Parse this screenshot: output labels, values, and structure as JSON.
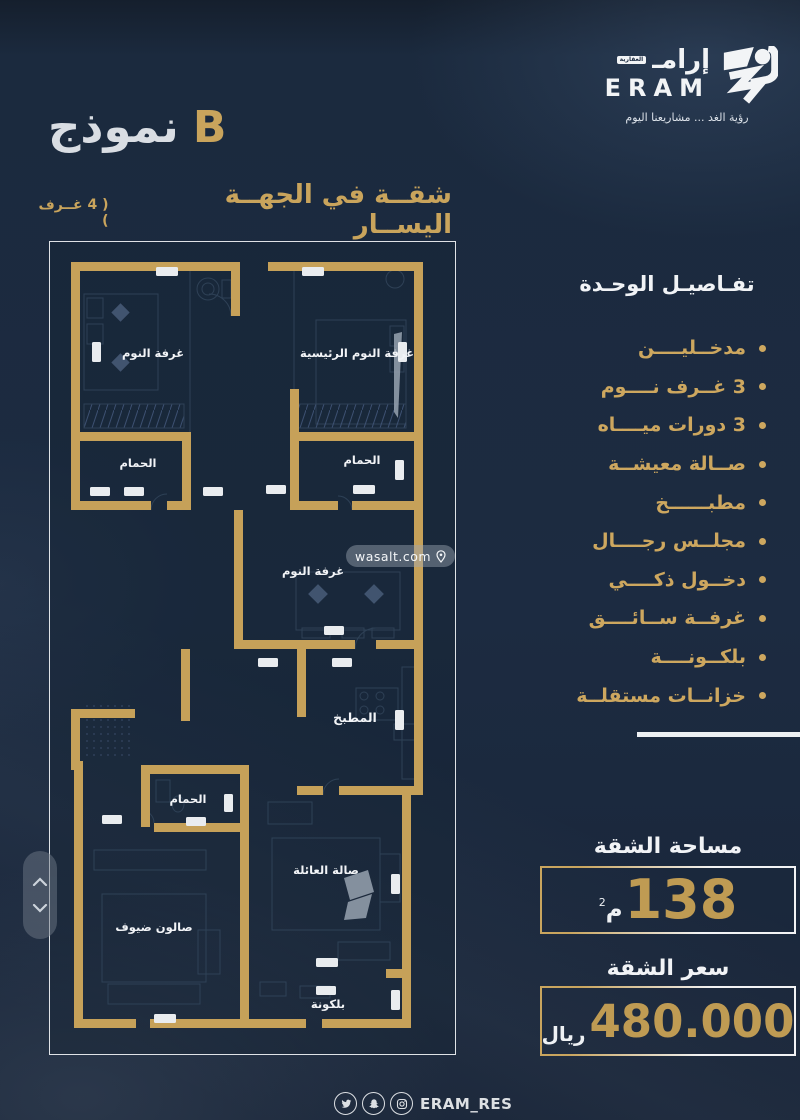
{
  "brand": {
    "name_arabic": "إرامـ",
    "name_tag": "العقارية",
    "name_latin": "ERAM",
    "tagline": "رؤية الغد ... مشاريعنا اليوم"
  },
  "header": {
    "model_label": "نموذج",
    "model_letter": "B",
    "subtitle": "شقــة في الجهــة اليســار",
    "subtitle_note": "( 4 غــرف )"
  },
  "plan": {
    "rooms": [
      {
        "label": "غرفة النوم"
      },
      {
        "label": "غرفة النوم الرئيسية"
      },
      {
        "label": "الحمام"
      },
      {
        "label": "الحمام"
      },
      {
        "label": "غرفة النوم"
      },
      {
        "label": "المطبخ"
      },
      {
        "label": "الحمام"
      },
      {
        "label": "صالون ضيوف"
      },
      {
        "label": "صالة العائلة"
      },
      {
        "label": "بلكونة"
      }
    ],
    "watermark": "wasalt.com"
  },
  "details": {
    "heading": "تفـاصيـل الوحـدة",
    "items": [
      "مدخــليــــن",
      "3 غــرف نــــوم",
      "3 دورات ميــــاه",
      "صــالة معيشــة",
      "مطبــــــخ",
      "مجلــس رجــــال",
      "دخــول ذكــــي",
      "غرفــة ســائــــق",
      "بلكــونــــة",
      "خزانــات مستقلــة"
    ]
  },
  "area": {
    "heading": "مساحة الشقة",
    "value": "138",
    "unit": "م",
    "unit_sup": "2"
  },
  "price": {
    "heading": "سعر الشقة",
    "value": "480.000",
    "currency": "ريال"
  },
  "footer": {
    "handle": "ERAM_RES",
    "icons": [
      "twitter-icon",
      "snapchat-icon",
      "instagram-icon"
    ]
  },
  "colors": {
    "gold": "#c9a45c",
    "navy": "#1c2b41",
    "white": "#f2f4f6"
  }
}
